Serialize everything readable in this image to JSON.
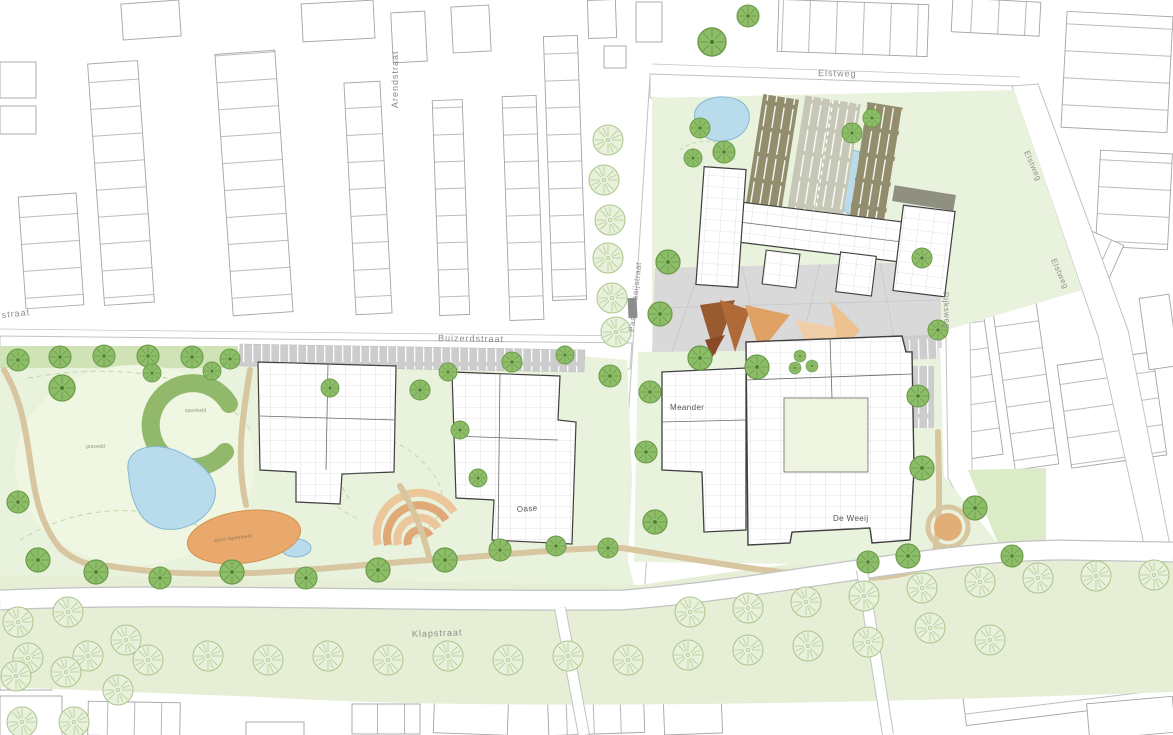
{
  "map": {
    "kind": "architectural site plan / landscape masterplan",
    "street_labels": {
      "arendstraat": "Arendstraat",
      "elstweg_top": "Elstweg",
      "elstweg_right_upper": "Elstweg",
      "elstweg_right_lower": "Elstweg",
      "buizerdstraat": "Buizerdstraat",
      "passewaaijstraat": "Passewaaijstraat",
      "klapstraat": "Klapstraat",
      "rijksweg": "Rijksweg",
      "straat_partial": "straat"
    },
    "building_labels": {
      "meander": "Meander",
      "de_weeij": "De Weeij",
      "oase": "Oase"
    },
    "area_labels": {
      "sportveld": "sport-/speelveld",
      "grasveld": "grasveld",
      "speelveld": "speelveld"
    },
    "palette": {
      "park_green": "#e9f2dc",
      "lawn_green": "#eff6e1",
      "verge_green": "#cfe3b6",
      "hedge_green": "#9fc478",
      "tree_green": "#8dbd68",
      "light_tree_green": "#e9f1dc",
      "pond_blue": "#b9dcec",
      "field_orange": "#e9a96d",
      "terrace_orange": "#dfa978",
      "art_brown": "#9a5a30",
      "plaza_gray": "#d9d9d9",
      "parking_gray": "#cdcdcd",
      "parking_olive": "#928d6d",
      "path_tan": "#d8c6a0",
      "road_edge_gray": "#c2c2c2",
      "building_outline": "#3e3e3e",
      "context_outline": "#a5a5a5"
    }
  }
}
